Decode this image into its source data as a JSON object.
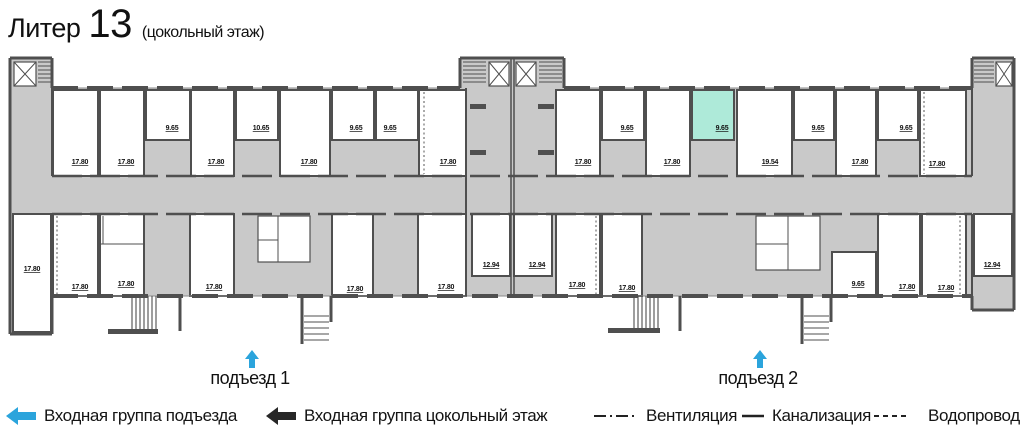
{
  "header": {
    "title_word": "Литер",
    "title_number": "13",
    "subtitle": "(цокольный этаж)"
  },
  "plan": {
    "wall_color": "#4f4f4f",
    "common_area_color": "#c9c9c9",
    "highlight_color": "#aeead9",
    "arrow_color": "#2ba4dc",
    "areas": {
      "lw1": "17.80",
      "lt1": "17.80",
      "lt2": "17.80",
      "lt3": "9.65",
      "lt4": "17.80",
      "lt5": "10.65",
      "lt6": "17.80",
      "lt7": "9.65",
      "lt8": "9.65",
      "lt9": "17.80",
      "lb1": "17.80",
      "lb2": "17.80",
      "lb3": "17.80",
      "lb4": "17.80",
      "lb5": "17.80",
      "lb6": "12.94",
      "rb0": "12.94",
      "rt1": "17.80",
      "rt2": "9.65",
      "rt3": "17.80",
      "rt4": "9.65",
      "rt5": "19.54",
      "rt6": "9.65",
      "rt7": "17.80",
      "rt8": "9.65",
      "rt9": "17.80",
      "rb1": "17.80",
      "rb2": "17.80",
      "rb3": "9.65",
      "rb4": "17.80",
      "rb5": "17.80",
      "rb6": "12.94"
    },
    "entrances": {
      "e1": "подъезд 1",
      "e2": "подъезд 2"
    }
  },
  "legend": {
    "entry_group_entrance": "Входная группа подъезда",
    "entry_group_basement": "Входная группа цокольный этаж",
    "ventilation": "Вентиляция",
    "sewerage": "Канализация",
    "water": "Водопровод"
  }
}
